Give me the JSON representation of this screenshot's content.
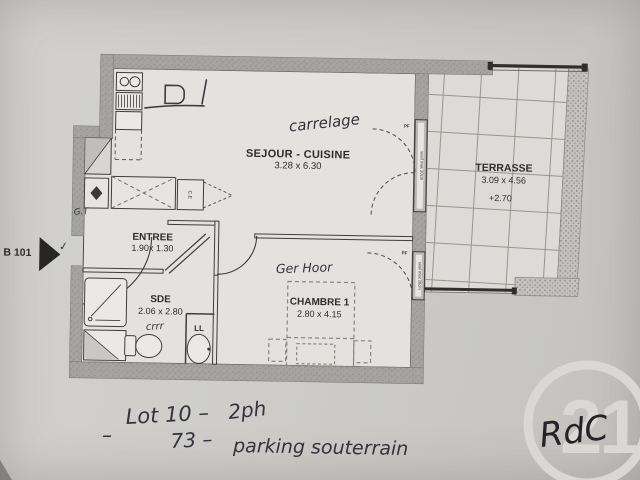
{
  "plan": {
    "unit": "B 101",
    "rooms": {
      "sejour_cuisine": {
        "name": "SEJOUR - CUISINE",
        "dims": "3.28 x 6.30"
      },
      "terrasse": {
        "name": "TERRASSE",
        "dims": "3.09 x 4.56",
        "level": "+2.70"
      },
      "entree": {
        "name": "ENTREE",
        "dims": "1.90x 1.30"
      },
      "sde": {
        "name": "SDE",
        "dims": "2.06 x 2.80"
      },
      "chambre": {
        "name": "CHAMBRE 1",
        "dims": "2.80 x 4.15"
      }
    },
    "labels": {
      "pf": "PF",
      "ll": "LL",
      "ce": "C.E",
      "window_note": "seuil max 20cm"
    }
  },
  "handwriting": {
    "carrelage": "carrelage",
    "gt": "G.T",
    "crrr": "crrr",
    "ger_floor": "Ger Hoor",
    "checkmark": "✓",
    "lot_line": "Lot 10 –",
    "lot_value": "2ph",
    "parking_number": "73 –",
    "parking_text": "parking souterrain",
    "dash": "–",
    "level": "RdC"
  },
  "watermark": {
    "number": "21"
  },
  "colors": {
    "paper": "#cecdca",
    "wall_gray": "#a5a4a0",
    "ink": "#2d2d2b",
    "handwriting_ink": "#33333a",
    "watermark_gray": "#d9d8d5"
  }
}
